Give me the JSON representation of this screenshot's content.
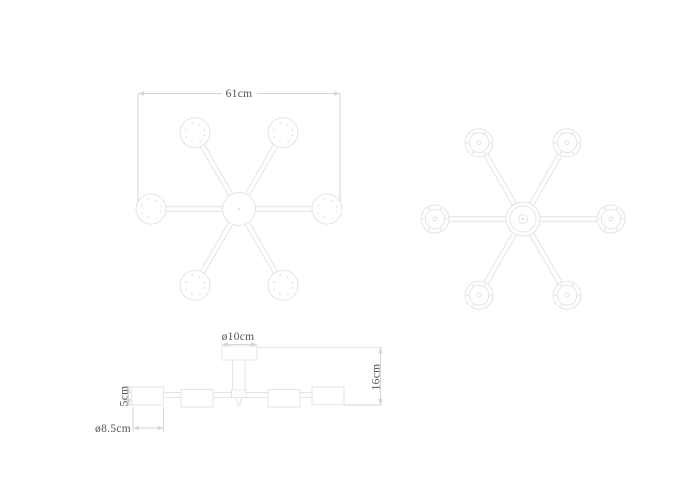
{
  "dimensions": {
    "top_view_width": "61cm",
    "canopy_diameter": "ø10cm",
    "fixture_height": "16cm",
    "shade_height": "5cm",
    "shade_diameter": "ø8.5cm"
  },
  "colors": {
    "background": "#ffffff",
    "drawing_line": "#e4e4e4",
    "dimension_line": "#d5d5d5",
    "dimension_text": "#555555"
  }
}
